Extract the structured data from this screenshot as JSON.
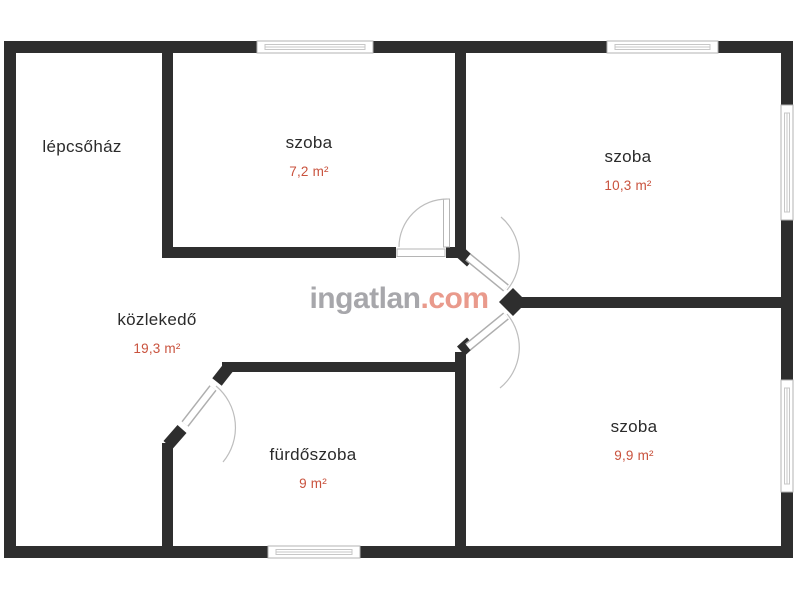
{
  "floorplan": {
    "wall_color": "#2e2e2e",
    "room_name_color": "#2b2b2b",
    "area_color": "#c9523d",
    "rooms": [
      {
        "label": "lépcsőház",
        "area": ""
      },
      {
        "label": "szoba",
        "area": "7,2 m²"
      },
      {
        "label": "szoba",
        "area": "10,3 m²"
      },
      {
        "label": "közlekedő",
        "area": "19,3 m²"
      },
      {
        "label": "fürdőszoba",
        "area": "9 m²"
      },
      {
        "label": "szoba",
        "area": "9,9 m²"
      }
    ],
    "watermark": {
      "name": "ingatlan",
      "tld": ".com",
      "name_color": "#a7a7ab",
      "tld_color": "#e99a8c"
    }
  }
}
